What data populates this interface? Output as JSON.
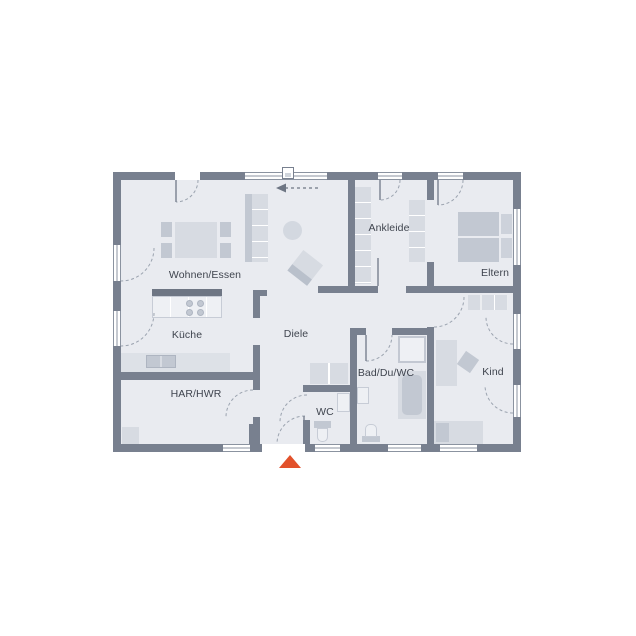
{
  "plan": {
    "type": "floor-plan",
    "rooms": {
      "wohnen_essen": {
        "label": "Wohnen/Essen"
      },
      "kueche": {
        "label": "Küche"
      },
      "diele": {
        "label": "Diele"
      },
      "har_hwr": {
        "label": "HAR/HWR"
      },
      "wc": {
        "label": "WC"
      },
      "bad_du_wc": {
        "label": "Bad/Du/WC"
      },
      "ankleide": {
        "label": "Ankleide"
      },
      "eltern": {
        "label": "Eltern"
      },
      "kind": {
        "label": "Kind"
      }
    },
    "markers": {
      "entrance_triangle": "up",
      "direction_arrow": "left"
    }
  },
  "colors": {
    "background": "#FFFFFF",
    "floor": "#E9EBF0",
    "wall": "#78808F",
    "furniture": "#D7DBE2",
    "furniture_dark": "#C2C8D2",
    "window_line": "#8B93A0",
    "arc": "#9BA3AF",
    "label_text": "#3F444E",
    "entrance_marker": "#E2512B"
  }
}
